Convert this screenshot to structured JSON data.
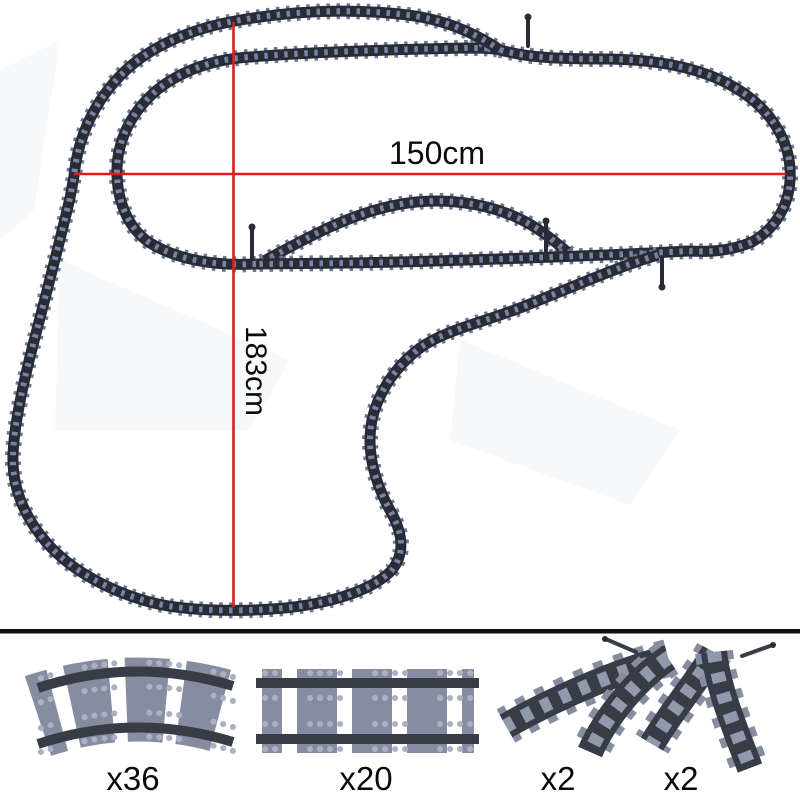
{
  "figure": {
    "width_label": "150cm",
    "height_label": "183cm"
  },
  "legend": {
    "items": [
      {
        "part": "curved-track",
        "count": "x36"
      },
      {
        "part": "straight-track",
        "count": "x20"
      },
      {
        "part": "switch-track-wye-left",
        "count": "x2"
      },
      {
        "part": "switch-track-wye-right",
        "count": "x2"
      }
    ]
  },
  "colors": {
    "red": "#e21a1d",
    "tie": "#6e7894",
    "tie-mid": "#7a84a0",
    "rail": "#272c37",
    "leg-tie": "#878da0",
    "leg-tie-mid": "#9199ac",
    "leg-rail": "#373c47",
    "stud": "#aab1c2",
    "divider": "#101010",
    "label": "#0a0a0a",
    "bg": "#ffffff"
  }
}
